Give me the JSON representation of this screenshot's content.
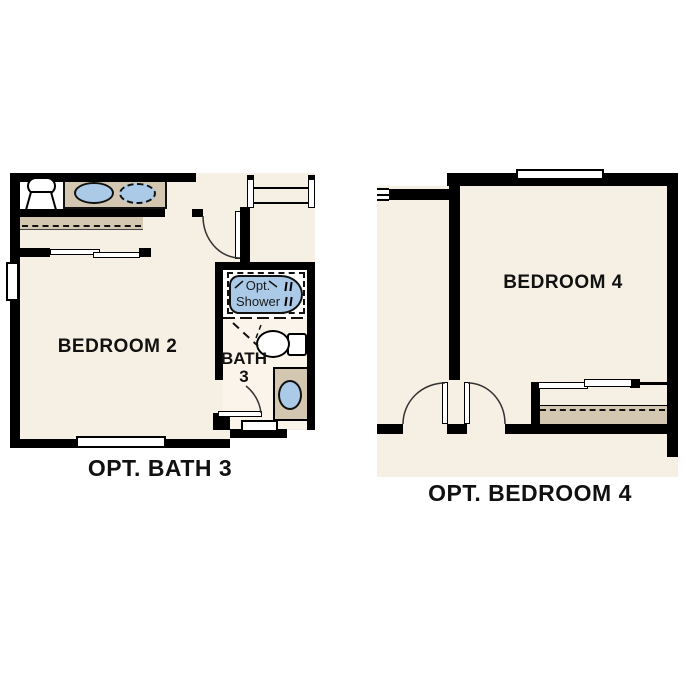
{
  "palette": {
    "floor": "#f6efe3",
    "accent_tan": "#d3c7b1",
    "fixture_blue": "#abcae8",
    "wall": "#000000",
    "background": "#ffffff"
  },
  "left_plan": {
    "room": "BEDROOM 2",
    "bath_line1": "BATH",
    "bath_line2": "3",
    "shower_line1": "Opt.",
    "shower_line2": "Shower",
    "caption": "OPT. BATH 3"
  },
  "right_plan": {
    "room": "BEDROOM 4",
    "caption": "OPT. BEDROOM 4"
  }
}
